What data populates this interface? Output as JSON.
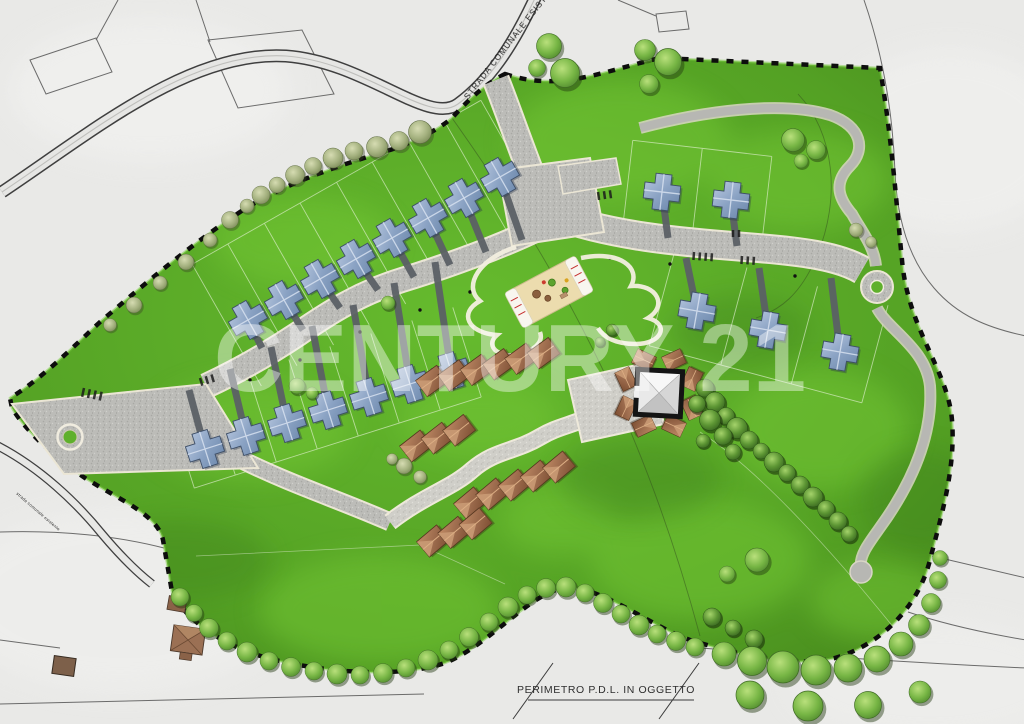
{
  "map": {
    "watermark": "CENTURY 21",
    "labels": {
      "existing_road_top": "STRADA COMUNALE ESISTE",
      "existing_road_left": "strada comunale esistente",
      "legend_perimeter": "PERIMETRO P.D.L.  IN OGGETTO"
    },
    "features": {
      "detached_houses_blue": 20,
      "terraced_house_clusters": 4,
      "central_courtyard_building": 1,
      "playground_area": 1,
      "roundabouts": 2,
      "perimeter_style": "black dashed boundary",
      "tree_count_approx": 95
    },
    "colors": {
      "paper": "#e9e9e7",
      "grass": "#54a124",
      "grass_light": "#74c735",
      "asphalt": "#bcbcb8",
      "paving": "#d0cfc9",
      "blue_roof": "#8ba3c4",
      "brown_roof": "#9b6a4c",
      "perimeter_dash": "#0d0d0d",
      "watermark": "#ffffff"
    }
  }
}
